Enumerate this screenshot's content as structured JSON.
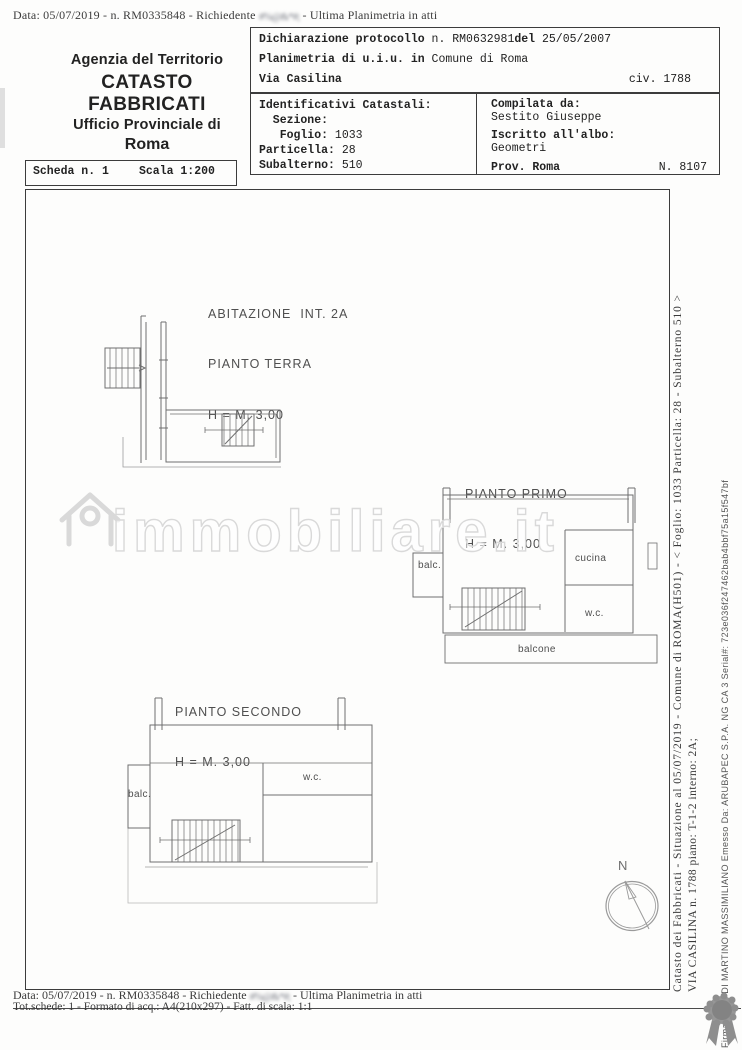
{
  "header": {
    "top_line": {
      "prefix": "Data: 05/07/2019 -  n. RM0335848 - Richiedente",
      "stamp": "#%@&*#;",
      "suffix": "- Ultima Planimetria in atti"
    },
    "agency": {
      "line1": "Agenzia del Territorio",
      "line2": "CATASTO FABBRICATI",
      "line3": "Ufficio Provinciale di",
      "line4": "Roma"
    },
    "declaration": {
      "label": "Dichiarazione protocollo",
      "number": "n. RM0632981",
      "del": "del",
      "date": "25/05/2007",
      "planimetria": "Planimetria di u.i.u. in",
      "comune": "Comune di Roma",
      "street": "Via Casilina",
      "civ": "civ. 1788"
    },
    "identifiers": {
      "title": "Identificativi Catastali:",
      "sezione": "  Sezione:",
      "foglio_label": "   Foglio:",
      "foglio_value": "1033",
      "particella_label": "Particella:",
      "particella_value": "28",
      "subalterno_label": "Subalterno:",
      "subalterno_value": "510"
    },
    "compiler": {
      "label": "Compilata da:",
      "name": "Sestito Giuseppe",
      "albo_label": "Iscritto all'albo:",
      "albo_value": "Geometri",
      "prov_label": "Prov. Roma",
      "number": "N. 8107"
    },
    "scheda": {
      "label": "Scheda n. 1",
      "scala": "Scala 1:200"
    }
  },
  "plans": {
    "terra": {
      "title": "ABITAZIONE  INT. 2A",
      "floor": "PIANTO TERRA",
      "height": "H = M. 3,00"
    },
    "primo": {
      "floor": "PIANTO PRIMO",
      "height": "H = M. 3,00",
      "room_balc": "balc.",
      "room_cucina": "cucina",
      "room_wc": "w.c.",
      "room_balcone": "balcone"
    },
    "secondo": {
      "floor": "PIANTO SECONDO",
      "height": "H = M. 3,00",
      "room_balc": "balc.",
      "room_wc": "w.c."
    }
  },
  "compass": {
    "label": "N"
  },
  "watermark": {
    "text": "immobiliare.it"
  },
  "margin_notes": {
    "catasto_line": "Catasto dei Fabbricati - Situazione al 05/07/2019 - Comune di ROMA(H501) - < Foglio: 1033 Particella: 28 - Subalterno 510 >",
    "address_line": "VIA CASILINA n. 1788 piano: T-1-2 interno: 2A;",
    "signature_line": "Firmato Da: DI MARTINO MASSIMILIANO Emesso Da: ARUBAPEC S.P.A. NG CA 3 Serial#: 723e036f247462bab4bbf75a15f547bf"
  },
  "footer": {
    "line1": {
      "prefix": "Data: 05/07/2019 -  n. RM0335848 - Richiedente",
      "stamp": "#%@&*#;",
      "suffix": "- Ultima Planimetria in atti"
    },
    "line2": "Tot.schede: 1 - Formato di acq.: A4(210x297) - Fatt. di scala: 1:1"
  },
  "colors": {
    "ink": "#2f2f2f",
    "line_gray": "#6f6f6f",
    "watermark_gray": "#d9d9d9",
    "seal_gray": "#8e8e8e"
  }
}
